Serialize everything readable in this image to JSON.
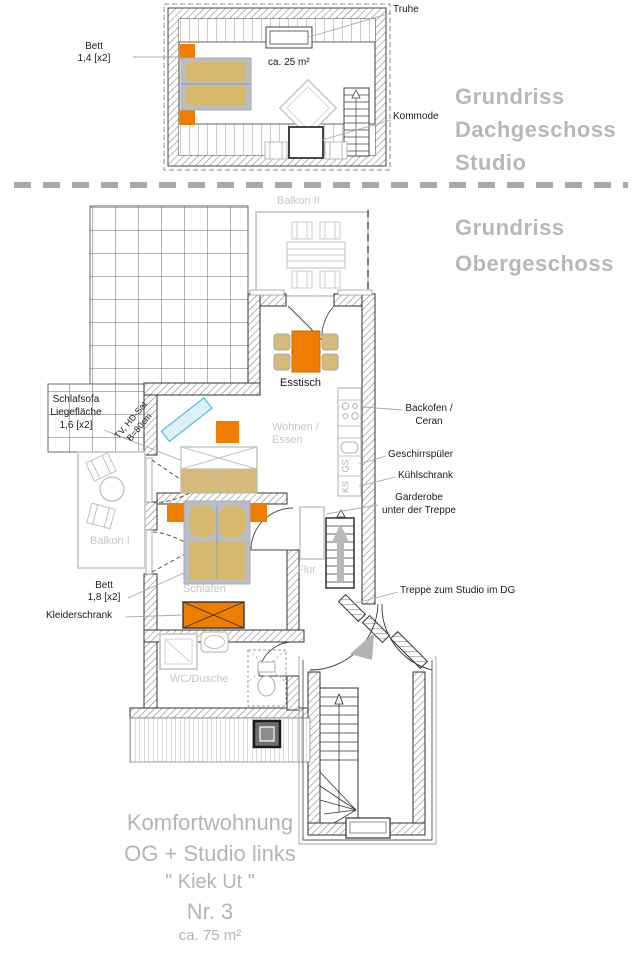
{
  "titles": {
    "dg1": "Grundriss",
    "dg2": "Dachgeschoss",
    "dg3": "Studio",
    "og1": "Grundriss",
    "og2": "Obergeschoss"
  },
  "studio": {
    "bett_label": "Bett",
    "bett_size": "1,4 [x2]",
    "truhe": "Truhe",
    "kommode": "Kommode",
    "area": "ca. 25 m²"
  },
  "og": {
    "balkon2": "Balkon II",
    "balkon1": "Balkon I",
    "esstisch": "Esstisch",
    "wohnen1": "Wohnen /",
    "wohnen2": "Essen",
    "schlafen": "Schlafen",
    "flur": "Flur",
    "wc": "WC/Dusche",
    "tv1": "TV, HD-Sat",
    "tv2": "B=80cm",
    "backofen1": "Backofen /",
    "backofen2": "Ceran",
    "geschirrspueler": "Geschirrspüler",
    "kuehlschrank": "Kühlschrank",
    "garderobe1": "Garderobe",
    "garderobe2": "unter der Treppe",
    "treppe_dg": "Treppe zum Studio im DG",
    "schlafsofa1": "Schlafsofa",
    "schlafsofa2": "Liegefläche",
    "schlafsofa3": "1,6 [x2]",
    "bett_label": "Bett",
    "bett_size": "1,8 [x2]",
    "kleiderschrank": "Kleiderschrank",
    "gs": "GS",
    "ks": "KS"
  },
  "footer": {
    "l1": "Komfortwohnung",
    "l2": "OG + Studio links",
    "l3": "\" Kiek Ut \"",
    "l4": "Nr. 3",
    "l5": "ca. 75 m²"
  },
  "colors": {
    "accent_orange": "#ee7d00",
    "furniture_tan": "#d5ba7a",
    "mattress_tan": "#d6b96d",
    "furniture_gray": "#b9bdc4",
    "tv_cyan": "#54bcd9",
    "label_gray": "#c6c6c6",
    "title_gray": "#b8b8b8"
  }
}
